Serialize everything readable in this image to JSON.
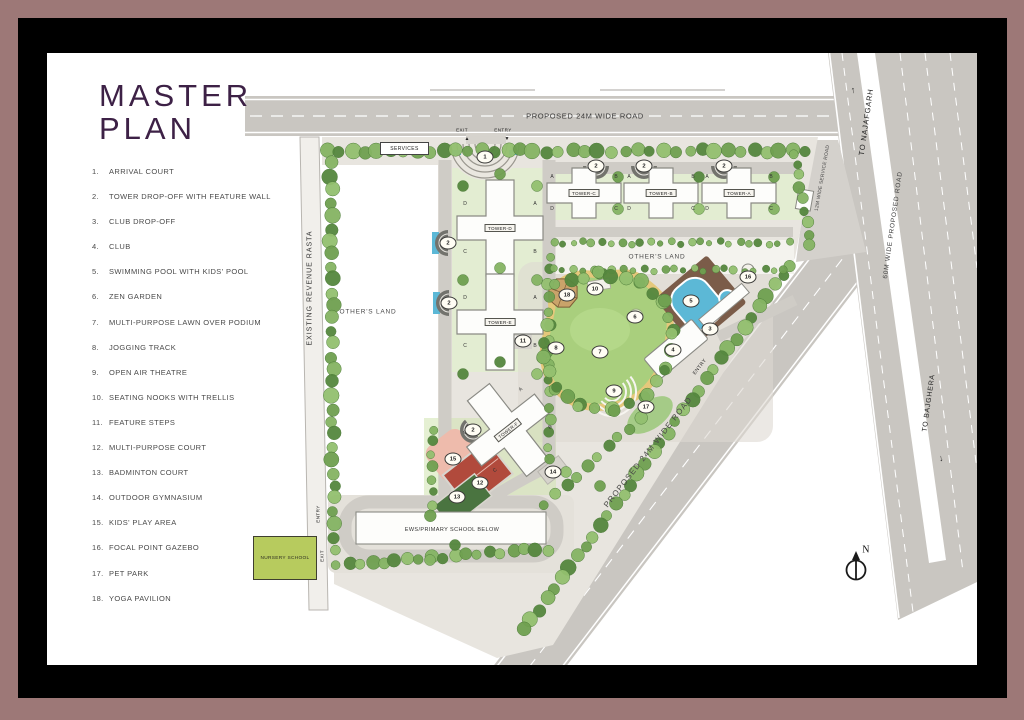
{
  "title": {
    "line1": "MASTER",
    "line2": "PLAN"
  },
  "legend": {
    "items": [
      {
        "n": "1.",
        "label": "ARRIVAL COURT"
      },
      {
        "n": "2.",
        "label": "TOWER DROP-OFF WITH FEATURE WALL"
      },
      {
        "n": "3.",
        "label": "CLUB DROP-OFF"
      },
      {
        "n": "4.",
        "label": "CLUB"
      },
      {
        "n": "5.",
        "label": "SWIMMING POOL WITH KIDS' POOL"
      },
      {
        "n": "6.",
        "label": "ZEN GARDEN"
      },
      {
        "n": "7.",
        "label": "MULTI-PURPOSE LAWN OVER PODIUM"
      },
      {
        "n": "8.",
        "label": "JOGGING TRACK"
      },
      {
        "n": "9.",
        "label": "OPEN AIR THEATRE"
      },
      {
        "n": "10.",
        "label": "SEATING NOOKS WITH TRELLIS"
      },
      {
        "n": "11.",
        "label": "FEATURE STEPS"
      },
      {
        "n": "12.",
        "label": "MULTI-PURPOSE COURT"
      },
      {
        "n": "13.",
        "label": "BADMINTON COURT"
      },
      {
        "n": "14.",
        "label": "OUTDOOR GYMNASIUM"
      },
      {
        "n": "15.",
        "label": "KIDS' PLAY AREA"
      },
      {
        "n": "16.",
        "label": "FOCAL POINT GAZEBO"
      },
      {
        "n": "17.",
        "label": "PET PARK"
      },
      {
        "n": "18.",
        "label": "YOGA PAVILION"
      }
    ]
  },
  "plan": {
    "roads": {
      "top": "PROPOSED 24M WIDE ROAD",
      "left": "EXISTING REVENUE RASTA",
      "diagonal": "PROPOSED 24M WIDE ROAD",
      "highway": "60M WIDE PROPOSED ROAD",
      "service": "12M WIDE SERVICE ROAD",
      "to_north": "TO NAJAFGARH",
      "to_south": "TO BAJGHERA"
    },
    "areas": {
      "others_land_left": "OTHER'S LAND",
      "others_land_right": "OTHER'S LAND",
      "services": "SERVICES",
      "nursery": "NURSERY SCHOOL",
      "ews": "EWS/PRIMARY SCHOOL BELOW"
    },
    "gates": {
      "exit": "EXIT",
      "entry": "ENTRY"
    },
    "icons": {
      "up_arrow": "↑",
      "down_arrow": "↓",
      "tri_up": "▲",
      "tri_down": "▼"
    },
    "compass_n": "N",
    "towers": [
      {
        "name": "TOWER-D",
        "x": 500,
        "y": 228,
        "orient": "v",
        "rot": 0,
        "wings": [
          "D",
          "A",
          "C",
          "B"
        ]
      },
      {
        "name": "TOWER-E",
        "x": 500,
        "y": 322,
        "orient": "v",
        "rot": 0,
        "wings": [
          "D",
          "A",
          "C",
          "B"
        ]
      },
      {
        "name": "TOWER-C",
        "x": 584,
        "y": 193,
        "orient": "h",
        "rot": 0,
        "wings": [
          "A",
          "B",
          "D",
          "C"
        ]
      },
      {
        "name": "TOWER-B",
        "x": 661,
        "y": 193,
        "orient": "h",
        "rot": 0,
        "wings": [
          "A",
          "B",
          "D",
          "C"
        ]
      },
      {
        "name": "TOWER-A",
        "x": 739,
        "y": 193,
        "orient": "h",
        "rot": 0,
        "wings": [
          "A",
          "B",
          "D",
          "C"
        ]
      },
      {
        "name": "TOWER-F",
        "x": 508,
        "y": 430,
        "orient": "v",
        "rot": -38,
        "wings": [
          "D",
          "A",
          "C",
          "B"
        ]
      }
    ],
    "markers": [
      {
        "n": "1",
        "x": 485,
        "y": 157
      },
      {
        "n": "2",
        "x": 448,
        "y": 243
      },
      {
        "n": "2",
        "x": 449,
        "y": 303
      },
      {
        "n": "2",
        "x": 596,
        "y": 166
      },
      {
        "n": "2",
        "x": 644,
        "y": 166
      },
      {
        "n": "2",
        "x": 724,
        "y": 166
      },
      {
        "n": "2",
        "x": 473,
        "y": 430
      },
      {
        "n": "3",
        "x": 710,
        "y": 329
      },
      {
        "n": "4",
        "x": 673,
        "y": 350
      },
      {
        "n": "5",
        "x": 691,
        "y": 301
      },
      {
        "n": "6",
        "x": 635,
        "y": 317
      },
      {
        "n": "7",
        "x": 600,
        "y": 352
      },
      {
        "n": "8",
        "x": 556,
        "y": 348
      },
      {
        "n": "9",
        "x": 614,
        "y": 391
      },
      {
        "n": "10",
        "x": 595,
        "y": 289
      },
      {
        "n": "11",
        "x": 523,
        "y": 341
      },
      {
        "n": "12",
        "x": 480,
        "y": 483
      },
      {
        "n": "13",
        "x": 457,
        "y": 497
      },
      {
        "n": "14",
        "x": 553,
        "y": 472
      },
      {
        "n": "15",
        "x": 453,
        "y": 459
      },
      {
        "n": "16",
        "x": 748,
        "y": 277
      },
      {
        "n": "17",
        "x": 646,
        "y": 407
      },
      {
        "n": "18",
        "x": 567,
        "y": 295
      }
    ]
  },
  "colors": {
    "frame": "#9d7877",
    "title_plum": "#3d2146",
    "road_gray": "#c9c6c1",
    "site_pale": "#e8e5df",
    "lawn_green": "#a9cf7d",
    "track_tan": "#e5c87b",
    "pool_blue": "#5cb8d6",
    "court_red": "#b14a3c",
    "kids_pink": "#eebbac",
    "badminton_green": "#4a7440",
    "nursery_green": "#b7cb5e",
    "tree_green": "#6fa050"
  }
}
